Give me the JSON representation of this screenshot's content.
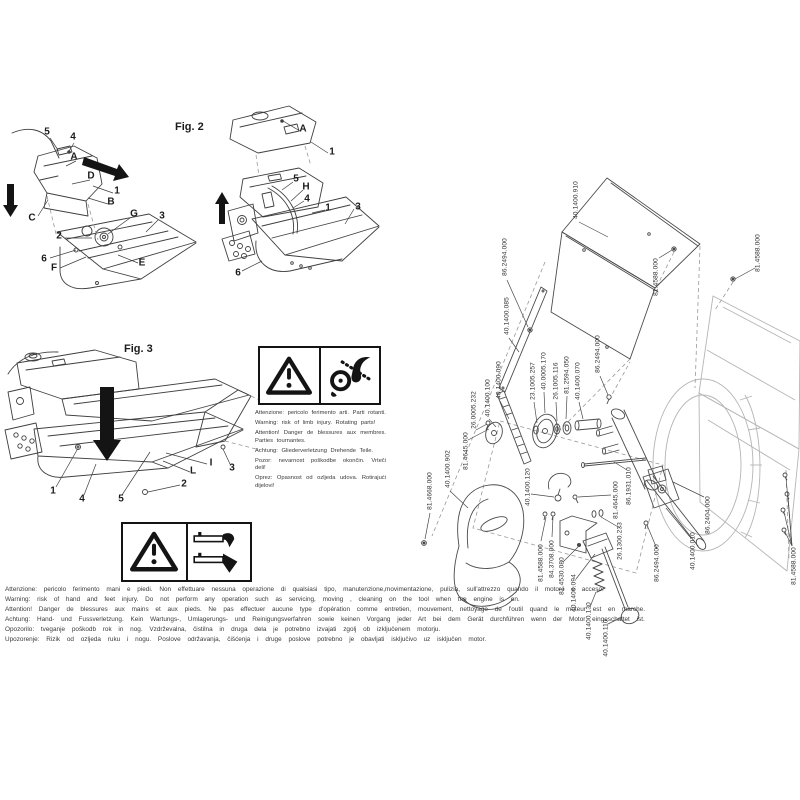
{
  "figures": {
    "fig2": {
      "title": "Fig. 2",
      "left_callouts": [
        "5",
        "4",
        "A",
        "D",
        "1",
        "B",
        "C",
        "G",
        "3",
        "2",
        "6",
        "F",
        "E"
      ],
      "right_callouts": [
        "A",
        "1",
        "5",
        "H",
        "4",
        "1",
        "3",
        "6"
      ]
    },
    "fig3": {
      "title": "Fig. 3",
      "callouts": [
        "1",
        "4",
        "5",
        "2",
        "3",
        "I",
        "L"
      ]
    }
  },
  "warnings": {
    "rotating": {
      "icon_left": "warning-triangle-icon",
      "icon_right": "rotating-parts-entanglement-icon",
      "lines": [
        "Attenzione: pericolo ferimento arti. Parti rotanti.",
        "Warning: risk of limb injury. Rotating parts!",
        "Attention! Danger de blessures aux membres. Parties tournantes.",
        "Achtung: Gliederverletzung Drehende Teile.",
        "Pozor: nevarnost poškodbe okončin. Vrteči deli!",
        "Oprez: Opasnost od ozljeda udova. Rotirajući dijelovi!"
      ]
    },
    "hand_feet": {
      "icon_left": "warning-triangle-icon",
      "icon_right": "hand-foot-injury-icon"
    },
    "bottom_lines": [
      "Attenzione: pericolo ferimento mani e piedi. Non effettuare nessuna operazione di qualsiasi tipo, manutenzione,movimentazione, pulizia, sull'attrezzo quando il motore è acceso.",
      "Warning: risk of hand and feet injury. Do not perform any operation such as servicing, moving , cleaning on the tool when the engine is on.",
      "Attention! Danger de blessures aux mains et aux pieds. Ne pas effectuer aucune type d'opération comme entretien, mouvement, nettoyage de l'outil quand le moteur est en marche.",
      "Achtung: Hand- und Fussverletzung. Kein Wartungs-, Umlagerungs- und Reinigungsverfahren sowie keinen Vorgang jeder Art bei dem Gerät durchführen wenn der Motor eingeschaltet ist.",
      "Opozorilo: tveganje poškodb rok in nog. Vzdrževalna, čistilna in druga dela je potrebno izvajati zgolj ob izključenem motorju.",
      "Upozorenje: Rizik od ozljeda ruku i nogu. Poslove održavanja, čišćenja i druge poslove potrebno je obavljati isključivo uz isključen motor."
    ]
  },
  "parts": {
    "labels": [
      "86.2494.000",
      "40.1400.910",
      "81.4588.000",
      "81.4588.000",
      "40.1400.085",
      "86.2494.000",
      "40.0005.170",
      "81.2594.050",
      "40.1400.090",
      "23.1005.257",
      "26.1005.116",
      "40.1400.070",
      "40.1400.100",
      "26.0005.232",
      "81.4645.000",
      "40.1400.902",
      "81.4668.000",
      "86.1931.010",
      "40.1400.120",
      "81.4645.000",
      "86.2404.000",
      "26.1300.233",
      "40.1400.010",
      "84.3708.000",
      "81.4588.000",
      "86.2494.000",
      "81.4588.000",
      "81.4530.080",
      "40.1400.094",
      "40.1400.130",
      "40.1400.110"
    ]
  },
  "colors": {
    "ink": "#3f3f3f",
    "light": "#b5b5b5",
    "black": "#141414"
  }
}
